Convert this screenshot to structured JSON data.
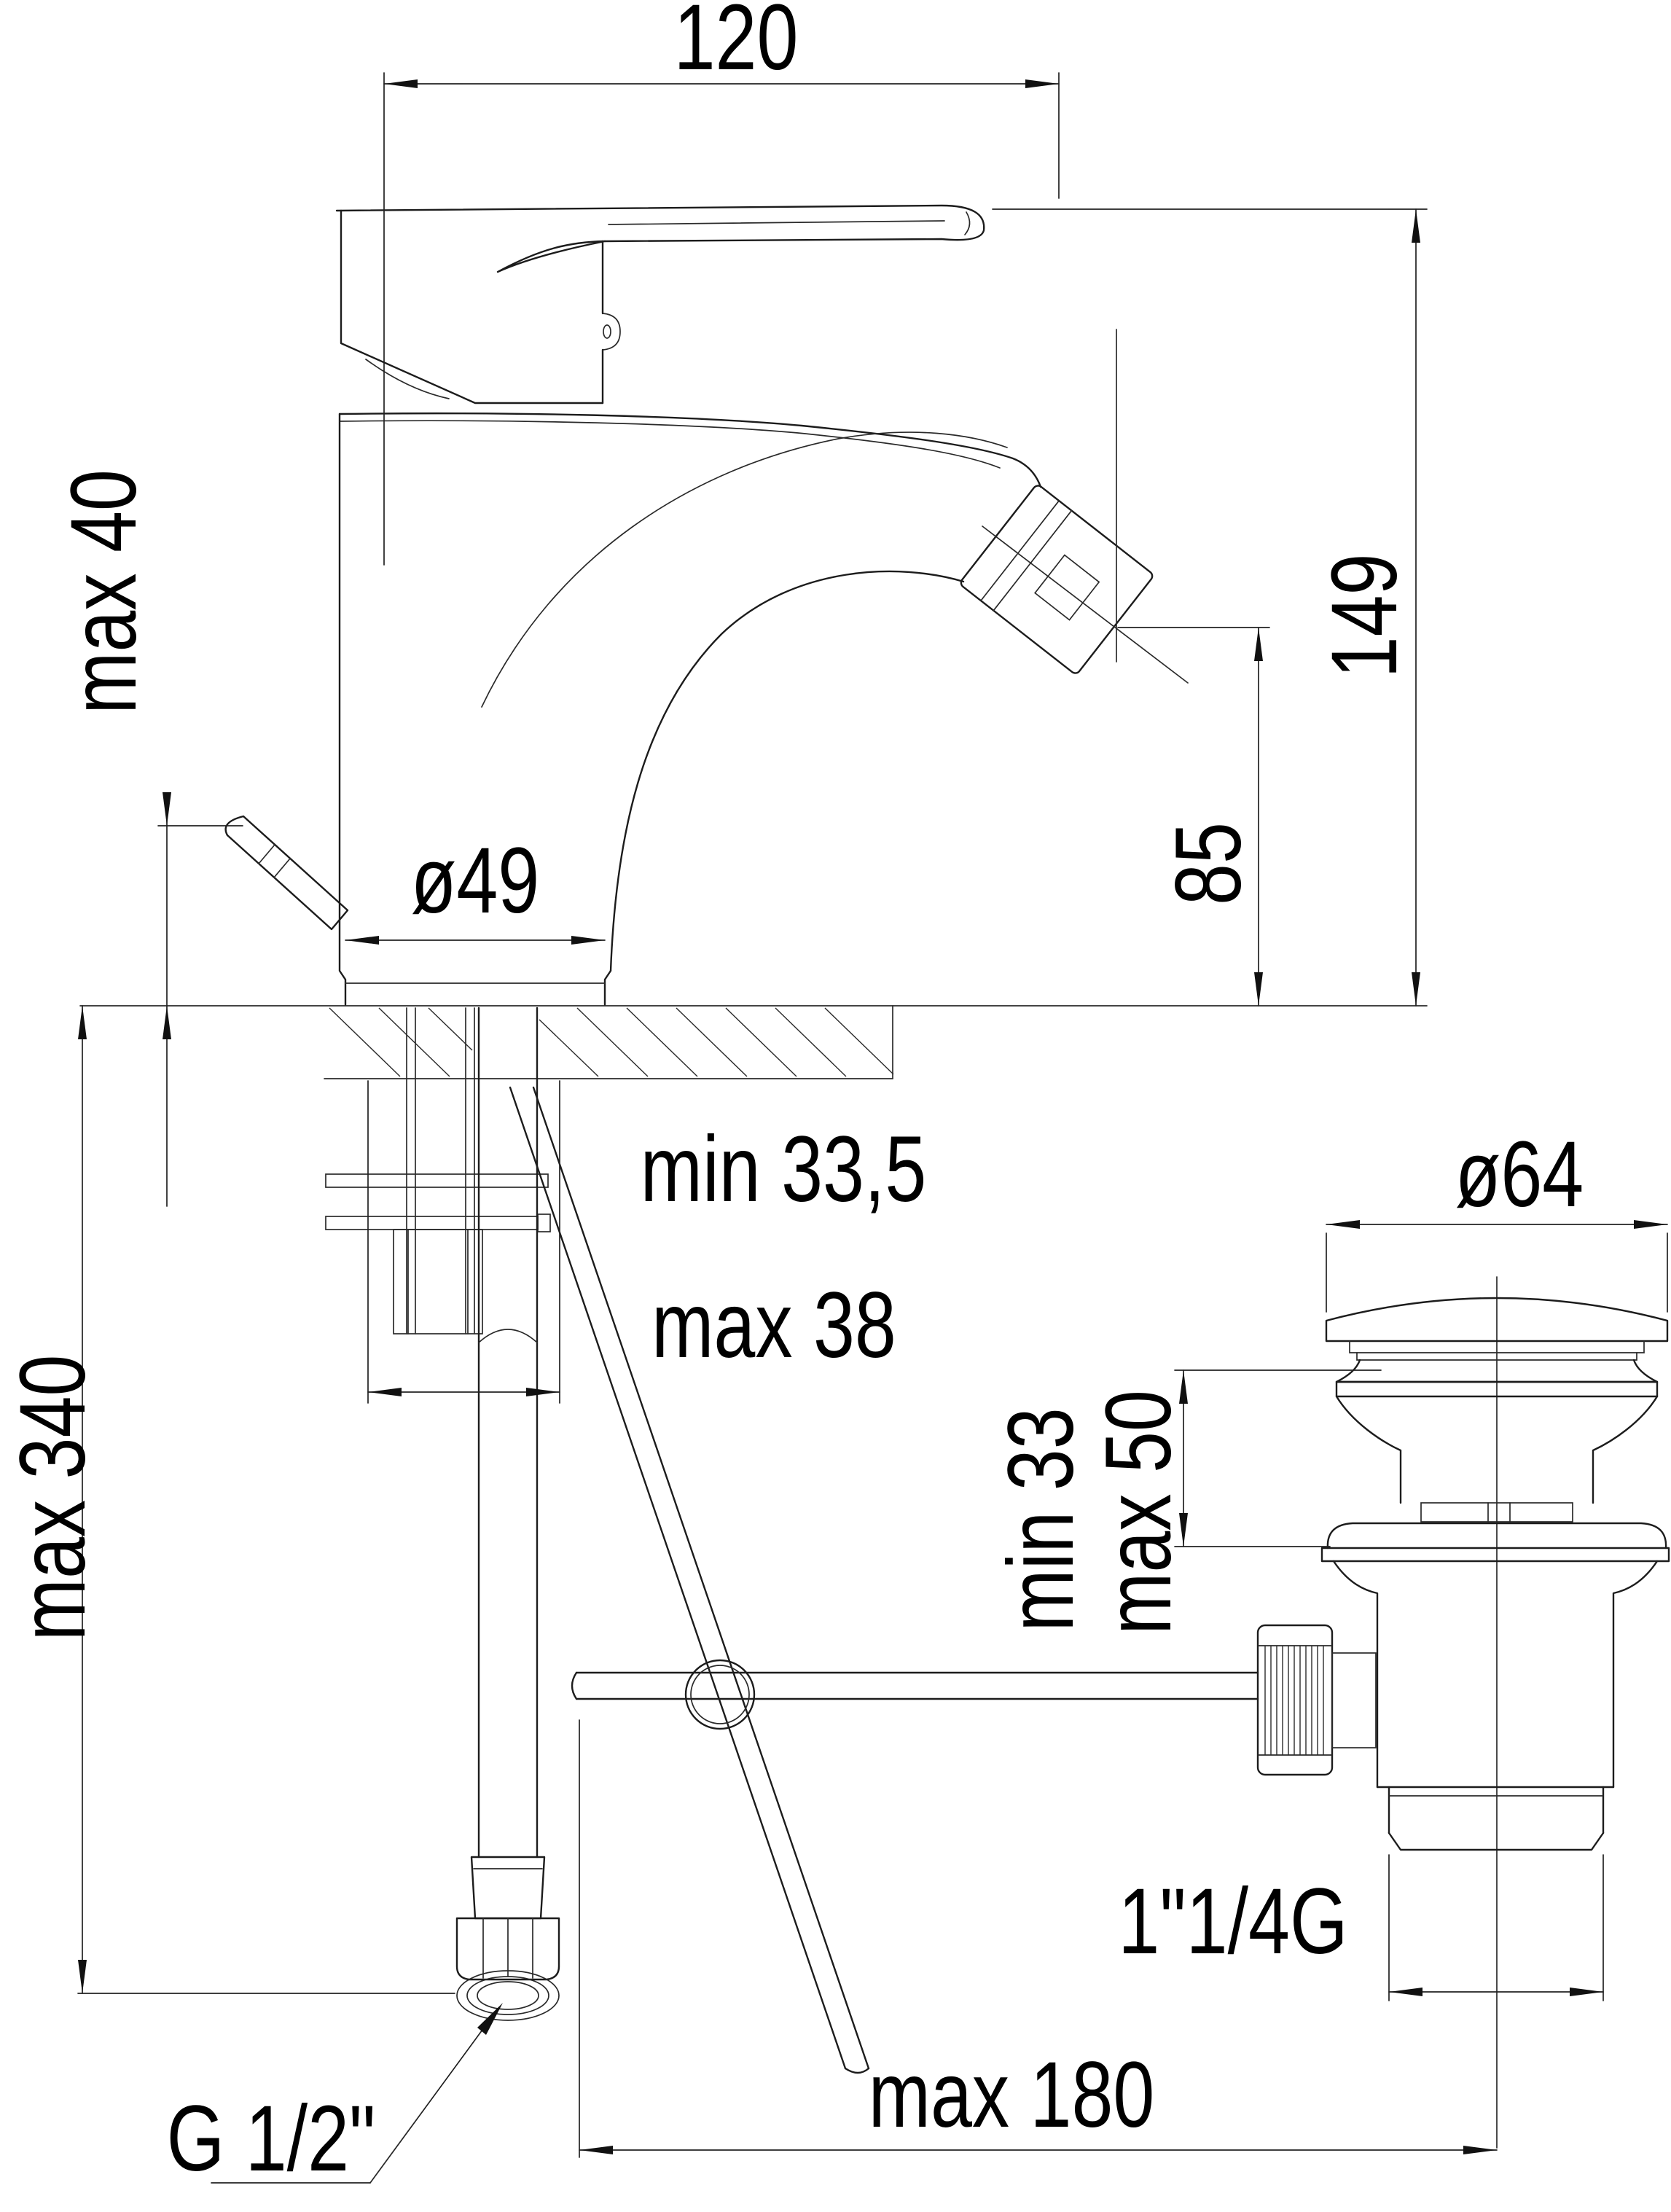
{
  "drawing": {
    "title": "bidet mixer technical drawing",
    "units": "mm",
    "line_color": "#1c1c1c",
    "background": "#ffffff"
  },
  "labels": {
    "spout_projection": "120",
    "total_height": "149",
    "spout_height": "85",
    "lever_max": "max 40",
    "body_diameter": "ø49",
    "deck_min": "min 33,5",
    "deck_max": "max 38",
    "supply_max": "max 340",
    "waste_cap_diameter": "ø64",
    "waste_deck_min": "min 33",
    "waste_deck_max": "max 50",
    "waste_thread": "1\"1/4G",
    "rod_reach_max": "max 180",
    "hose_thread": "G 1/2\""
  }
}
